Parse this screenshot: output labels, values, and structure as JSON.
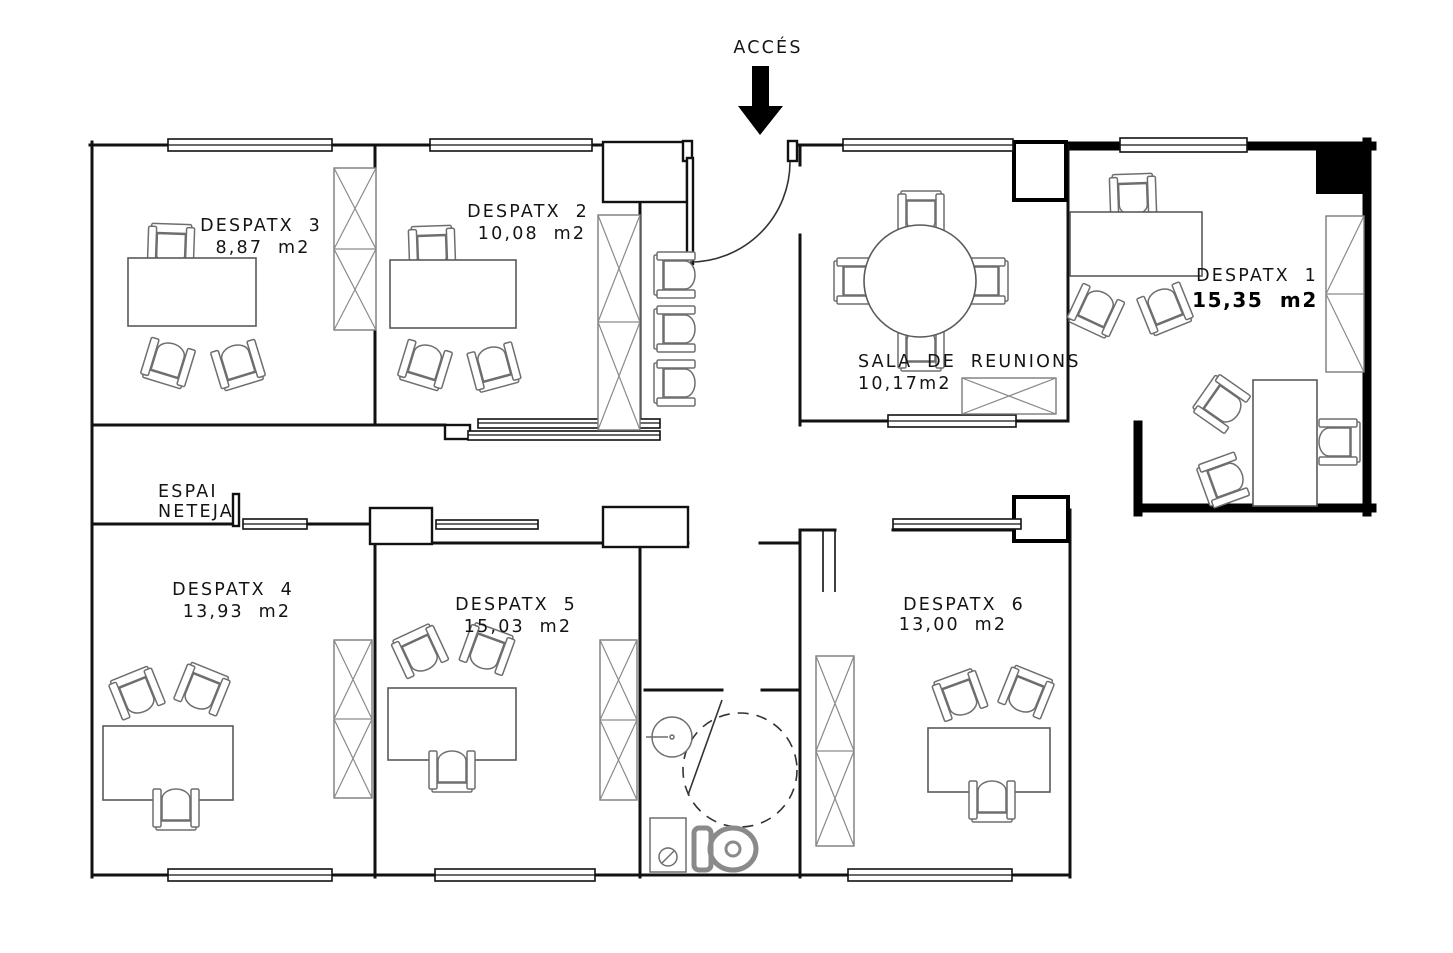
{
  "plan": {
    "access_label": "ACCÉS",
    "rooms": {
      "d3": {
        "name": "DESPATX 3",
        "area": "8,87 m2"
      },
      "d2": {
        "name": "DESPATX 2",
        "area": "10,08 m2"
      },
      "sala": {
        "name": "SALA DE REUNIONS",
        "area": "10,17m2"
      },
      "d1": {
        "name": "DESPATX 1",
        "area": "15,35 m2"
      },
      "espai": {
        "name_line1": "ESPAI",
        "name_line2": "NETEJA"
      },
      "d4": {
        "name": "DESPATX 4",
        "area": "13,93 m2"
      },
      "d5": {
        "name": "DESPATX 5",
        "area": "15,03 m2"
      },
      "d6": {
        "name": "DESPATX 6",
        "area": "13,00 m2"
      }
    },
    "colors": {
      "wall": "#111111",
      "furniture": "#6e6e6e",
      "accent": "#000000"
    }
  }
}
